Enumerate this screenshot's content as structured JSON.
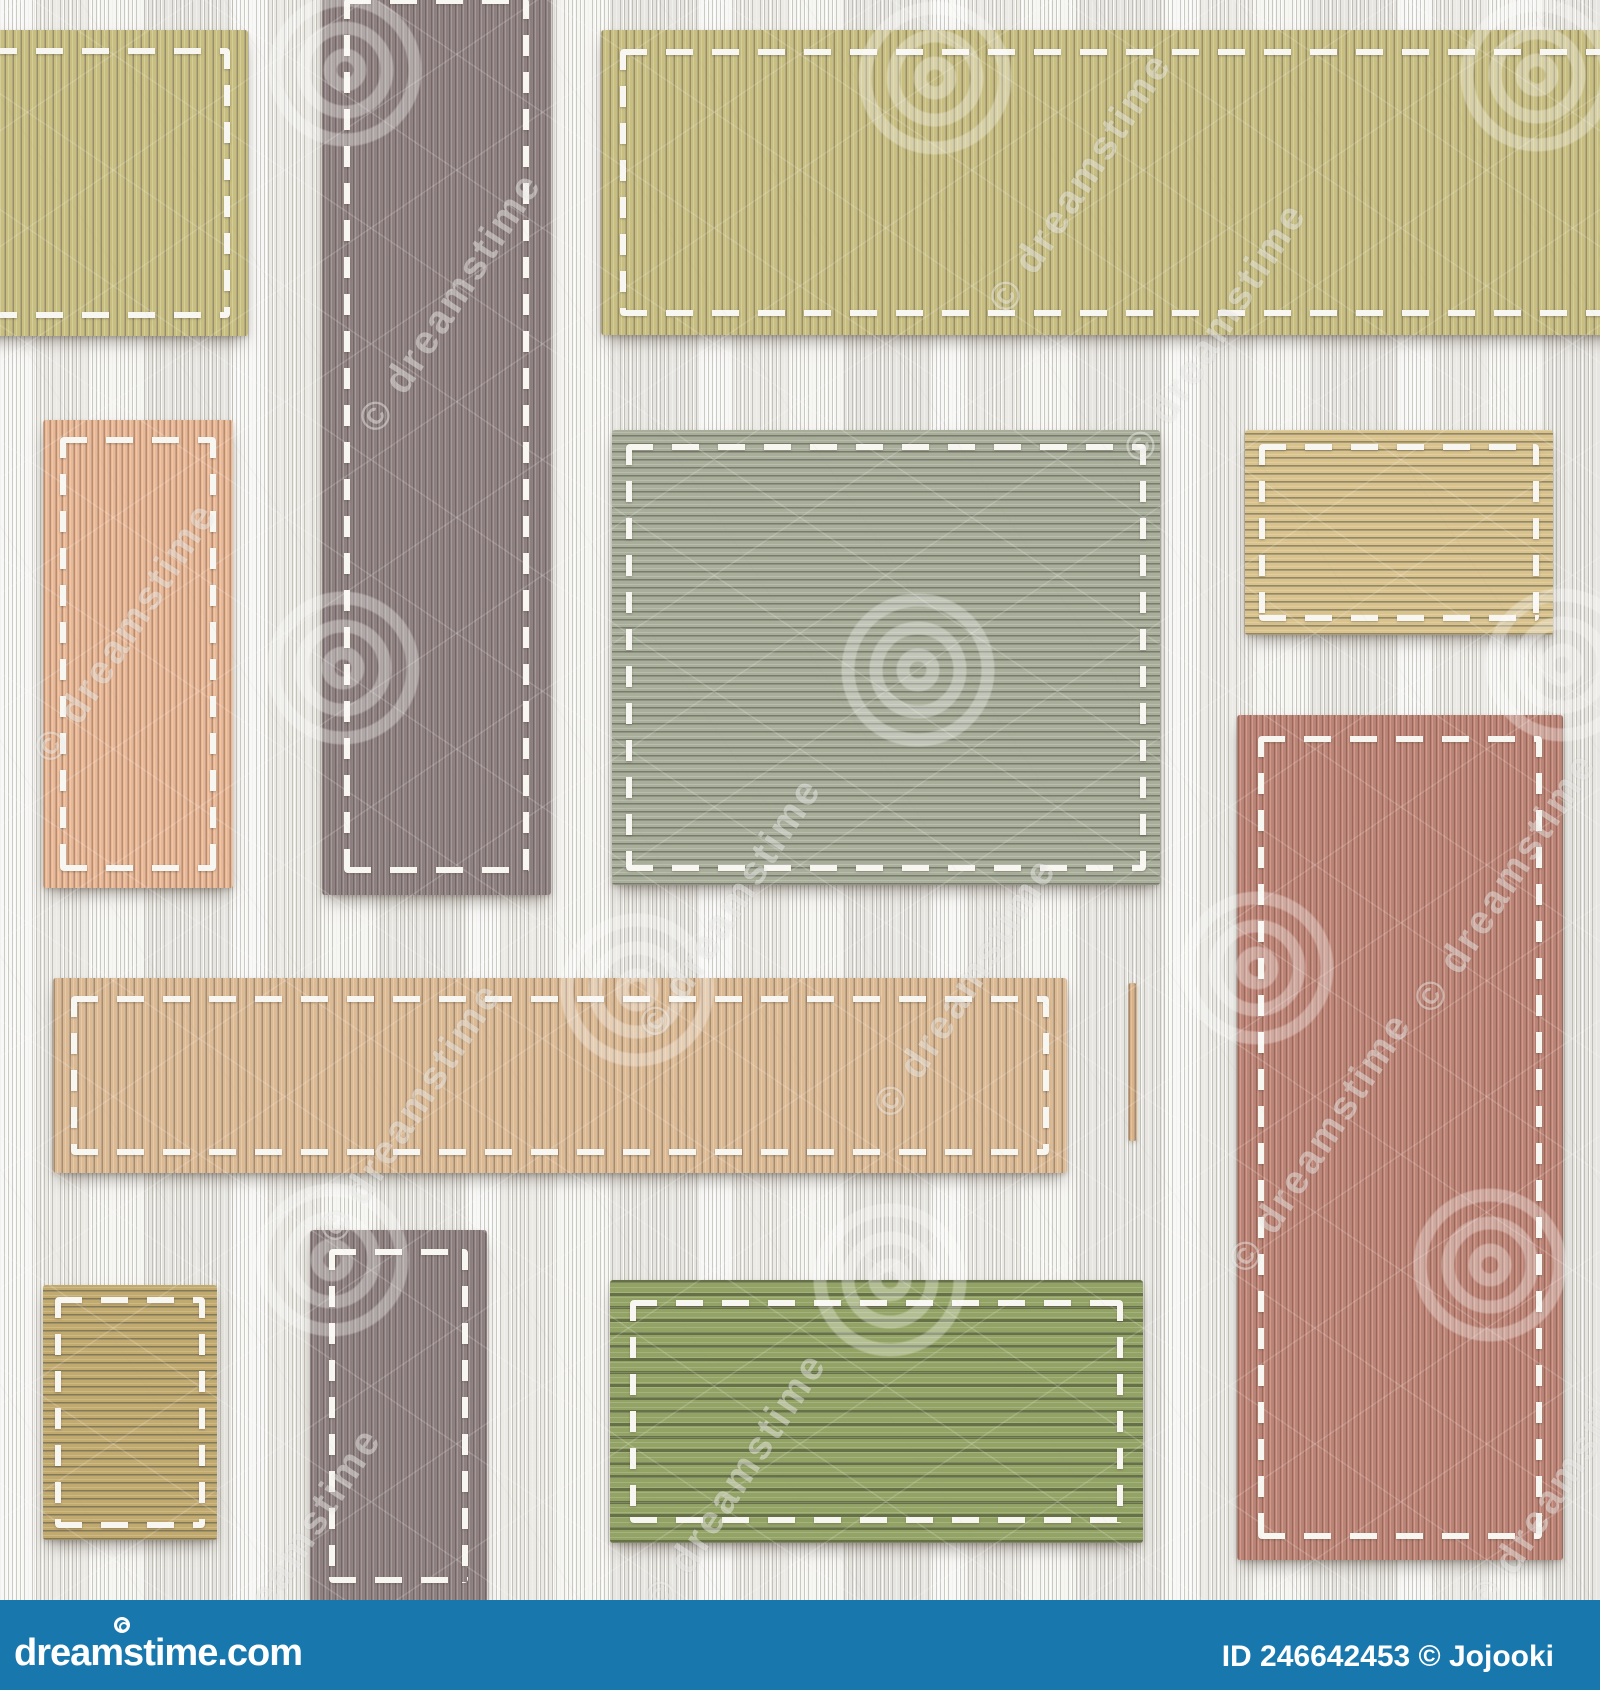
{
  "image": {
    "description": "Seamless decorative textile patchwork pattern - colored ribbed fabric rectangles stitched with white thread onto a white corduroy background",
    "background_color": "#f2f1ed",
    "stitch_color": "#f8f6f1"
  },
  "patches": [
    {
      "id": "olive-top-left",
      "color": "#c7be80",
      "rib_class": "rib-v",
      "x": -28,
      "y": 30,
      "w": 276,
      "h": 306,
      "stitch_inset": 18
    },
    {
      "id": "mauve-band-top",
      "color": "#8d7f7f",
      "rib_class": "rib-v-fine",
      "x": 322,
      "y": -24,
      "w": 229,
      "h": 919,
      "stitch_inset": 22
    },
    {
      "id": "olive-top-right",
      "color": "#c7be80",
      "rib_class": "rib-v",
      "x": 601,
      "y": 30,
      "w": 1025,
      "h": 305,
      "stitch_inset": 19
    },
    {
      "id": "peach-rect-left",
      "color": "#ecb894",
      "rib_class": "rib-v-fine",
      "x": 43,
      "y": 420,
      "w": 190,
      "h": 468,
      "stitch_inset": 17
    },
    {
      "id": "sage-square-center",
      "color": "#a8ae9a",
      "rib_class": "rib-h",
      "x": 612,
      "y": 430,
      "w": 548,
      "h": 455,
      "stitch_inset": 14
    },
    {
      "id": "khaki-rect-top-right",
      "color": "#d9c28b",
      "rib_class": "rib-h",
      "x": 1245,
      "y": 430,
      "w": 308,
      "h": 205,
      "stitch_inset": 14
    },
    {
      "id": "terracotta-rect-right",
      "color": "#c08273",
      "rib_class": "rib-v-fine",
      "x": 1237,
      "y": 715,
      "w": 326,
      "h": 845,
      "stitch_inset": 21
    },
    {
      "id": "tan-band-middle",
      "color": "#dcba94",
      "rib_class": "rib-v",
      "x": 53,
      "y": 978,
      "w": 1014,
      "h": 195,
      "stitch_inset": 18
    },
    {
      "id": "tan-sliver",
      "color": "#d9b288",
      "rib_class": "rib-v-fine",
      "x": 1128,
      "y": 983,
      "w": 9,
      "h": 158,
      "stitch": false
    },
    {
      "id": "khaki-rect-bottom-left",
      "color": "#c2a96e",
      "rib_class": "rib-h",
      "x": 43,
      "y": 1285,
      "w": 174,
      "h": 255,
      "stitch_inset": 12
    },
    {
      "id": "mauve-band-bottom",
      "color": "#8d7f7f",
      "rib_class": "rib-v-fine",
      "x": 310,
      "y": 1230,
      "w": 177,
      "h": 372,
      "stitch_inset": 19
    },
    {
      "id": "moss-rect-bottom",
      "color": "#93a365",
      "rib_class": "rib-h-wide",
      "x": 610,
      "y": 1280,
      "w": 533,
      "h": 263,
      "stitch_inset": 20
    }
  ],
  "watermarks": {
    "label": "dreamstime",
    "copyright_label": "© dreamstime",
    "spiral_centers": [
      [
        345,
        70
      ],
      [
        935,
        78
      ],
      [
        1537,
        75
      ],
      [
        343,
        668
      ],
      [
        918,
        670
      ],
      [
        1562,
        665
      ],
      [
        637,
        990
      ],
      [
        1257,
        968
      ],
      [
        332,
        1260
      ],
      [
        890,
        1280
      ],
      [
        1490,
        1265
      ]
    ],
    "text_centers": [
      [
        95,
        630
      ],
      [
        420,
        300
      ],
      [
        1050,
        180
      ],
      [
        700,
        905
      ],
      [
        380,
        1110
      ],
      [
        935,
        985
      ],
      [
        1185,
        330
      ],
      [
        1290,
        1140
      ],
      [
        705,
        1480
      ],
      [
        1475,
        880
      ],
      [
        260,
        1555
      ],
      [
        1530,
        1480
      ]
    ]
  },
  "footer": {
    "background_color": "#1878ad",
    "logo_text": "dreamstime.com",
    "credit_text": "ID 246642453 © Jojooki"
  }
}
